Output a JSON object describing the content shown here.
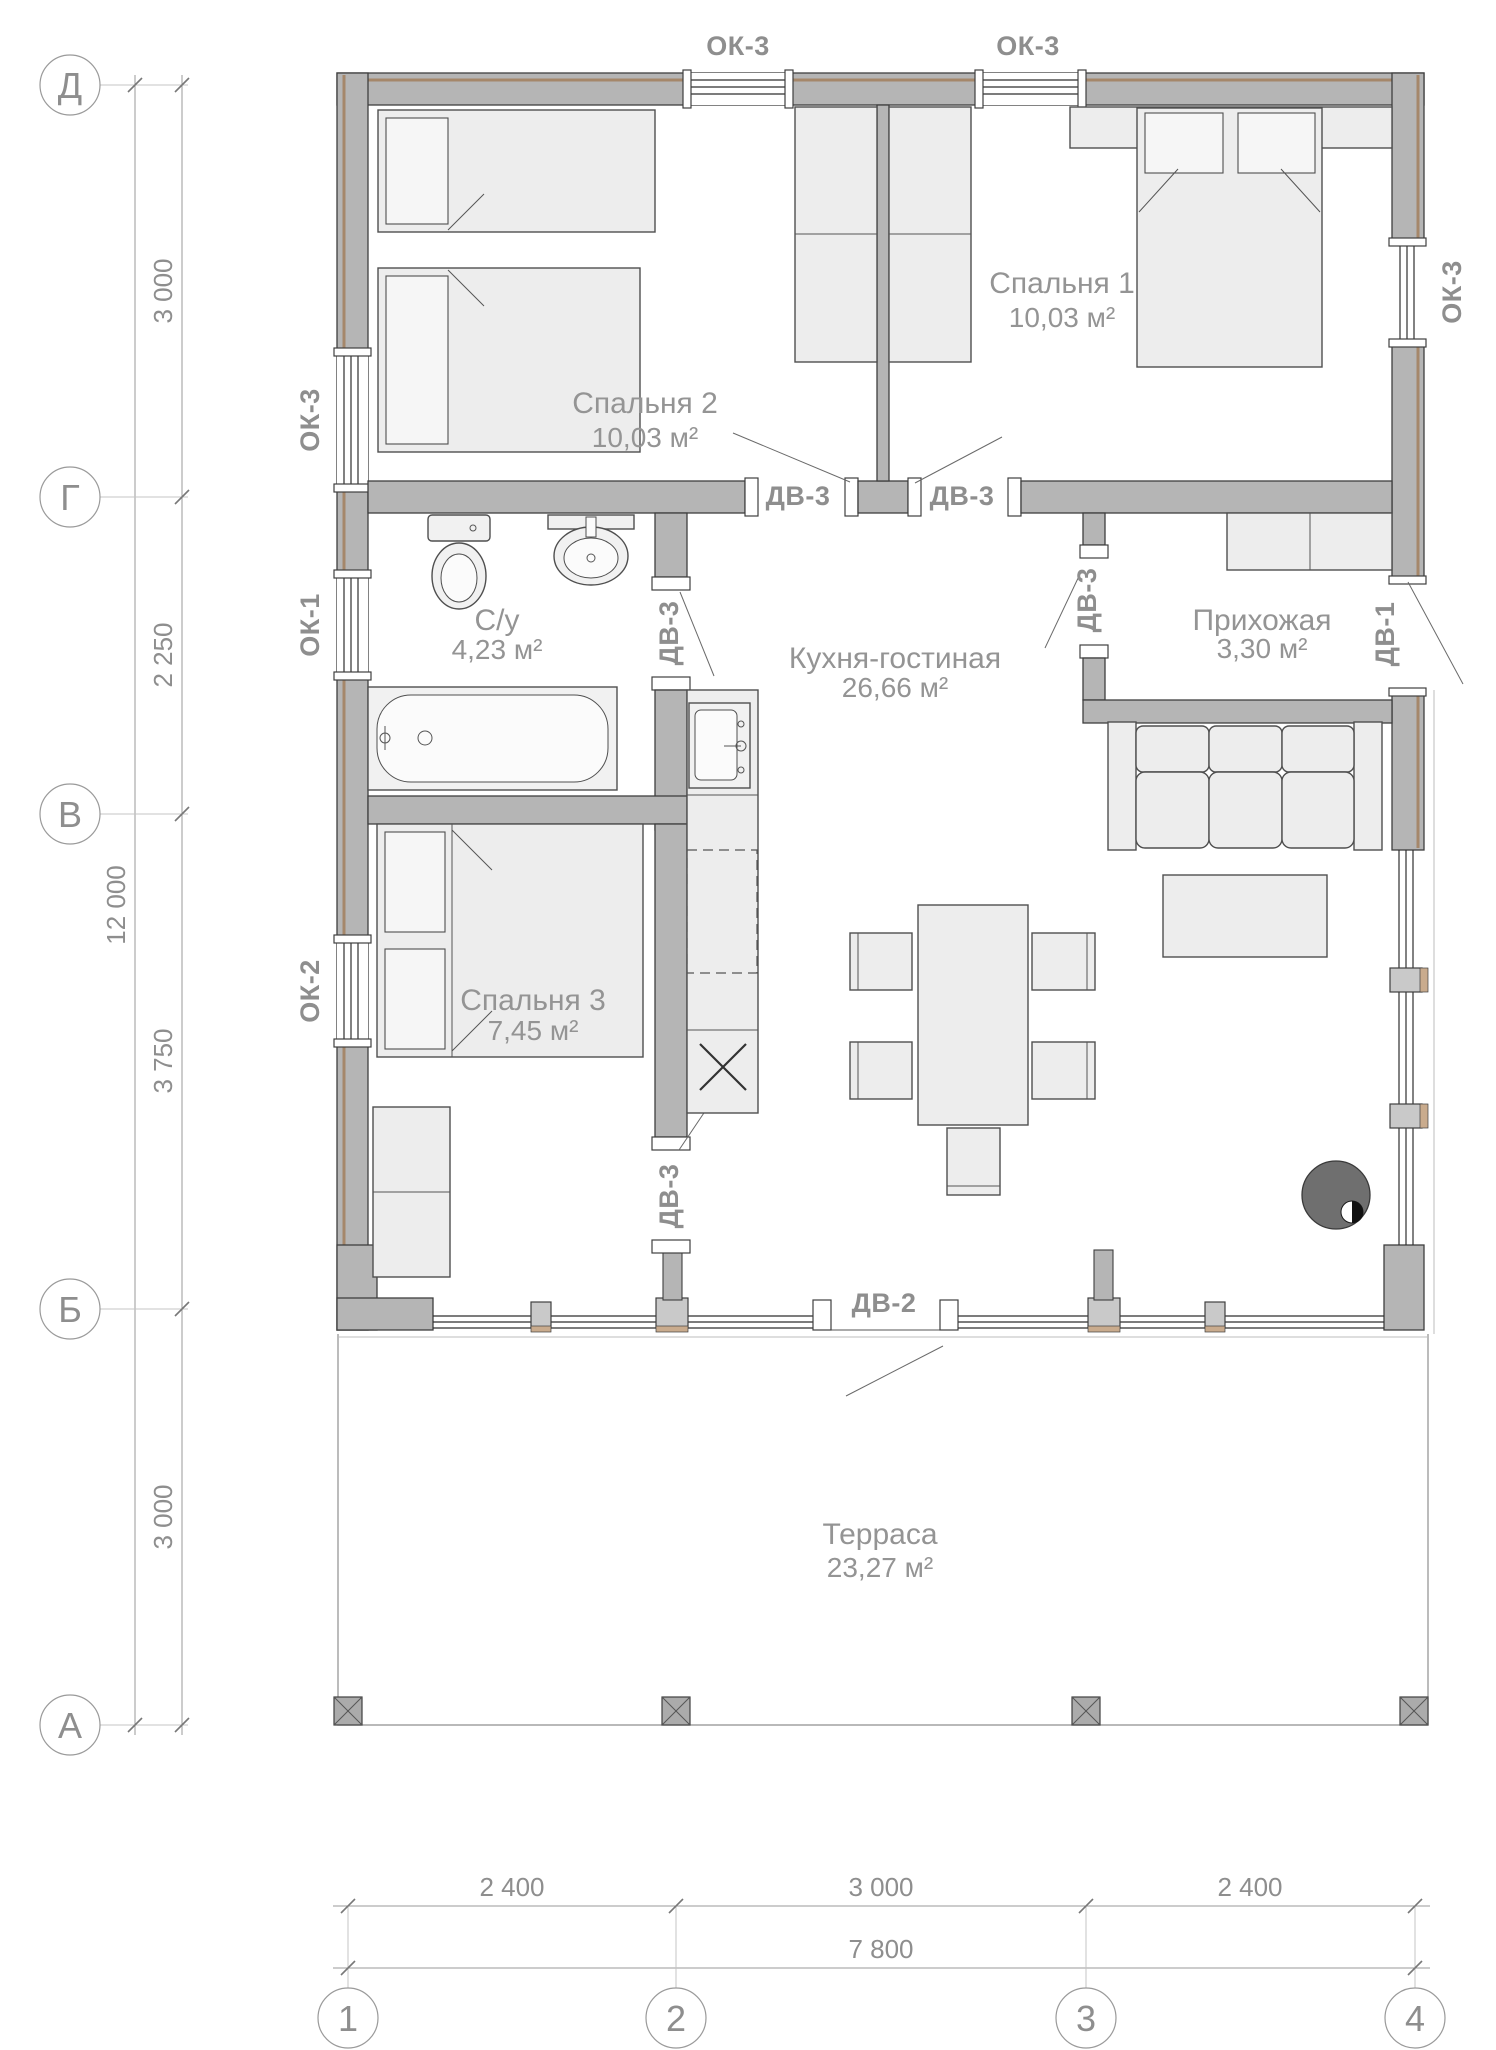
{
  "rooms": [
    {
      "name": "Спальня 2",
      "area": "10,03 м²"
    },
    {
      "name": "Спальня 1",
      "area": "10,03 м²"
    },
    {
      "name": "С/у",
      "area": "4,23 м²"
    },
    {
      "name": "Кухня-гостиная",
      "area": "26,66 м²"
    },
    {
      "name": "Прихожая",
      "area": "3,30 м²"
    },
    {
      "name": "Спальня 3",
      "area": "7,45 м²"
    },
    {
      "name": "Терраса",
      "area": "23,27 м²"
    }
  ],
  "markers": {
    "top_windows": [
      "ОК-3",
      "ОК-3"
    ],
    "left_windows": [
      "ОК-3",
      "ОК-1",
      "ОК-2"
    ],
    "right_window": "ОК-3",
    "bedroom_doors": [
      "ДВ-3",
      "ДВ-3"
    ],
    "bath_door": "ДВ-3",
    "hall_door": "ДВ-3",
    "bedroom3_door": "ДВ-3",
    "entry_door": "ДВ-1",
    "terrace_door": "ДВ-2"
  },
  "axes": {
    "rows": [
      "Д",
      "Г",
      "В",
      "Б",
      "А"
    ],
    "cols": [
      "1",
      "2",
      "3",
      "4"
    ]
  },
  "dims": {
    "left_chain": [
      "3 000",
      "2 250",
      "3 750",
      "3 000"
    ],
    "left_total": "12 000",
    "bottom_chain": [
      "2 400",
      "3 000",
      "2 400"
    ],
    "bottom_total": "7 800"
  },
  "colors": {
    "wall": "#b5b5b5",
    "cladding": "#a5876a",
    "label": "#8e8e8e"
  }
}
